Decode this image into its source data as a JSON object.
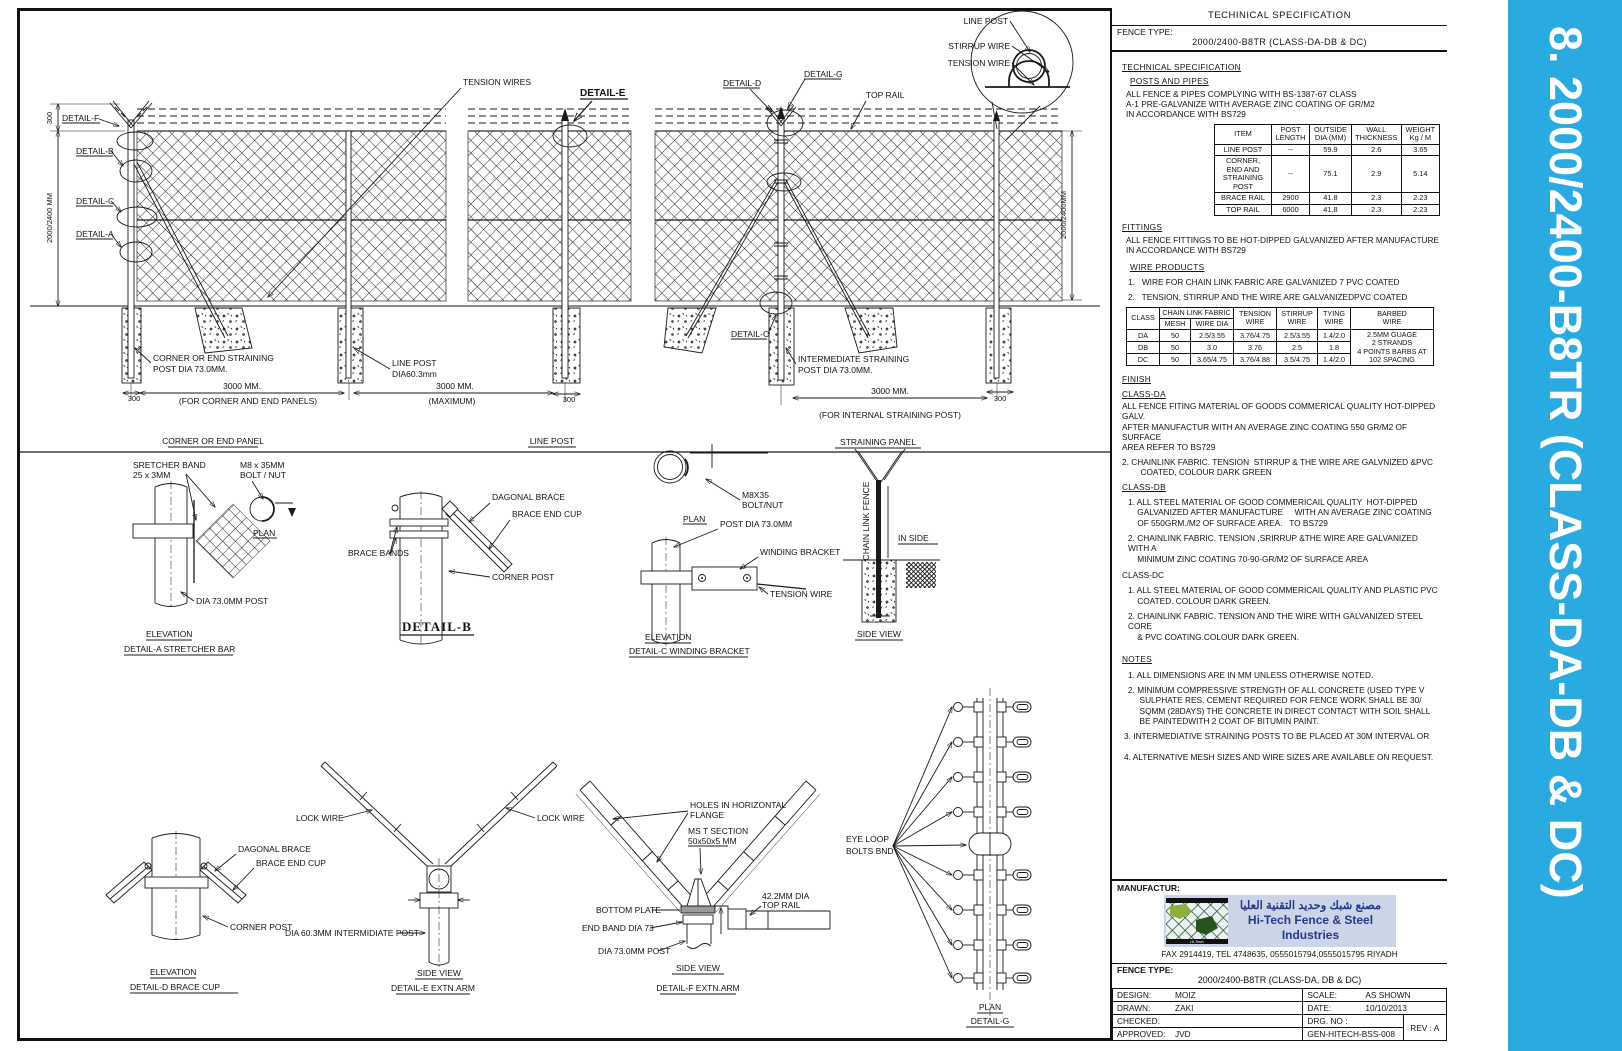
{
  "colors": {
    "accent_blue": "#29ABE2",
    "logo_blue": "#28368e",
    "logo_bg": "#ccd5e8",
    "logo_green": "#1e5b13"
  },
  "sidebar": {
    "title": "8. 2000/2400-B8TR (CLASS-DA-DB & DC)"
  },
  "panel": {
    "header": "TECHINICAL SPECIFICATION",
    "fence_type_label": "FENCE TYPE:",
    "fence_type_value": "2000/2400-B8TR (CLASS-DA-DB & DC)",
    "sec_heading": "TECHNICAL SPECIFICATION",
    "posts_heading": "POSTS AND PIPES",
    "posts_text": "ALL FENCE & PIPES COMPLYING WITH BS-1387-67 CLASS\nA-1 PRE-GALVANIZE WITH AVERAGE ZINC COATING OF GR/M2\nIN ACCORDANCE WITH BS729",
    "posts_table": {
      "headers": [
        "ITEM",
        "POST\nLENGTH",
        "OUTSIDE\nDIA (MM)",
        "WALL\nTHICKNESS",
        "WEIGHT\nKg / M"
      ],
      "rows": [
        [
          "LINE POST",
          "--",
          "59.9",
          "2.6",
          "3.65"
        ],
        [
          "CORNER, END AND\nSTRAINING POST",
          "--",
          "75.1",
          "2.9",
          "5.14"
        ],
        [
          "BRACE RAIL",
          "2900",
          "41.8",
          "2.3",
          "2.23"
        ],
        [
          "TOP RAIL",
          "6000",
          "41.8",
          "2.3",
          "2.23"
        ]
      ]
    },
    "fittings_heading": "FITTINGS",
    "fittings_text": "ALL FENCE FITTINGS TO BE HOT-DIPPED GALVANIZED AFTER MANUFACTURE\nIN ACCORDANCE WITH BS729",
    "wire_products_heading": "WIRE PRODUCTS",
    "wire_item1": "1.   WIRE FOR CHAIN LINK FABRIC ARE GALVANIZED 7 PVC COATED",
    "wire_item2": "2.   TENSION, STIRRUP AND THE WIRE ARE GALVANIZEDPVC COATED",
    "wire_table": {
      "class_header": "CLASS",
      "chainlink_header": "CHAIN LINK FABRIC",
      "mesh_header": "MESH",
      "wiredia_header": "WIRE DIA",
      "tension_header": "TENSION\nWIRE",
      "stirrup_header": "STIRRUP\nWIRE",
      "tying_header": "TYING\nWIRE",
      "barbed_header": "BARBED\nWIRE",
      "rows": [
        [
          "DA",
          "50",
          "2.5/3.55",
          "3.76/4.75",
          "2.5/3.55",
          "1.4/2.0"
        ],
        [
          "DB",
          "50",
          "3.0",
          "3.76",
          "2.5",
          "1.8"
        ],
        [
          "DC",
          "50",
          "3.65/4.75",
          "3.76/4.88",
          "3.5/4.75",
          "1.4/2.0"
        ]
      ],
      "barbed_text": "2.5MM  GUAGE\n2 STRANDS\n4 POINTS BARBS AT\n102 SPACING"
    },
    "finish_heading": "FINISH",
    "class_da": "CLASS-DA",
    "da_text": "ALL FENCE FITING MATERIAL OF GOODS COMMERICAL QUALITY HOT-DIPPED GALV.\nAFTER MANUFACTUR WITH AN AVERAGE ZINC COATING 550 GR/M2 OF SURFACE\nAREA REFER TO BS729",
    "da_item2": "2. CHAINLINK FABRIC. TENSION  STIRRUP & THE WIRE ARE GALVNIZED &PVC\n        COATED, COLOUR DARK GREEN",
    "class_db": "CLASS-DB",
    "db_item1": "1. ALL STEEL MATERIAL OF GOOD COMMERICAIL QUALITY  HOT-DIPPED\n    GALVANIZED AFTER MANUFACTURE     WITH AN AVERAGE ZINC COATING\n    OF 550GRM./M2 OF SURFACE AREA.   TO BS729",
    "db_item2": "2. CHAINLINK FABRIC. TENSION ,SRIRRUP &THE WIRE ARE GALVANIZED WITH A\n    MINIMUM ZINC COATING 70-90-GR/M2 OF SURFACE AREA",
    "class_dc": "CLASS-DC",
    "dc_item1": "1. ALL STEEL MATERIAL OF GOOD COMMERICAIL QUALITY AND PLASTIC PVC\n    COATED. COLOUR DARK GREEN.",
    "dc_item2": "2. CHAINLINK FABRIC. TENSION AND THE WIRE WITH GALVANIZED STEEL CORE\n    & PVC COATING.COLOUR DARK GREEN.",
    "notes_heading": "NOTES",
    "notes": [
      "1. ALL DIMENSIONS ARE IN MM UNLESS OTHERWISE NOTED.",
      "2. MINIMUM COMPRESSIVE STRENGTH OF ALL CONCRETE (USED TYPE V\n     SULPHATE RES. CEMENT REQUIRED FOR FENCE WORK SHALL BE 30/\n     SQMM (28DAYS) THE CONCRETE IN DIRECT CONTACT WITH SOIL SHALL\n     BE PAINTEDWITH 2 COAT OF BITUMIN PAINT.",
      "3. INTERMEDIATIVE STRAINING POSTS TO BE PLACED AT 30M INTERVAL OR",
      "4. ALTERNATIVE MESH SIZES AND WIRE SIZES ARE AVAILABLE ON REQUEST."
    ]
  },
  "title_block": {
    "manufacturer_label": "MANUFACTUR:",
    "logo_arabic": "مصنع شبك وحديد التقنية العليا",
    "logo_english": "Hi-Tech Fence & Steel Industries",
    "logo_strip": "Hi-Tech",
    "contact": "FAX 2914419, TEL 4748635,   0555015794,0555015795 RIYADH",
    "fence_type_label": "FENCE TYPE:",
    "fence_type_value": "2000/2400-B8TR (CLASS-DA, DB & DC)",
    "design_label": "DESIGN:",
    "design_value": "MOIZ",
    "scale_label": "SCALE:",
    "scale_value": "AS SHOWN",
    "drawn_label": "DRAWN:",
    "drawn_value": "ZAKI",
    "date_label": "DATE:",
    "date_value": "10/10/2013",
    "checked_label": "CHECKED:",
    "checked_value": "",
    "drg_label": "DRG. NO :",
    "drg_value": "GEN-HITECH-BSS-008",
    "approved_label": "APPROVED:",
    "approved_value": "JVD",
    "rev": "REV : A"
  },
  "labels": {
    "line_post": "LINE POST",
    "stirrup_wire": "STIRRUP WIRE",
    "tension_wire": "TENSION WIRE",
    "tension_wires": "TENSION WIRES",
    "top_rail": "TOP RAIL",
    "detail_a": "DETAIL-A",
    "detail_b": "DETAIL-B",
    "detail_c": "DETAIL-C",
    "detail_d": "DETAIL-D",
    "detail_e": "DETAIL-E",
    "detail_f": "DETAIL-F",
    "detail_g": "DETAIL-G",
    "dim_300": "300",
    "dim_height": "2000/2400 MM",
    "dim_height_right": "2000/2400MM",
    "dim_3000": "3000 MM.",
    "cap_corner": "(FOR CORNER AND END PANELS)",
    "cap_max": "(MAXIMUM)",
    "cap_internal": "(FOR INTERNAL STRAINING POST)",
    "corner_straining_1": "CORNER OR END STRAINING",
    "corner_straining_2": "POST DIA 73.0MM.",
    "line_post_dia": "DIA60.3mm",
    "intermediate_1": "INTERMEDIATE STRAINING",
    "title_corner": "CORNER OR END PANEL",
    "title_straining": "STRAINING PANEL",
    "stretcher_1": "SRETCHER BAND",
    "stretcher_2": "25 x 3MM",
    "m8_1": "M8 x 35MM",
    "m8_2": "BOLT / NUT",
    "plan": "PLAN",
    "dia73_post": "DIA 73.0MM POST",
    "elevation": "ELEVATION",
    "detail_a_title": "DETAIL-A STRETCHER BAR",
    "brace_bands": "BRACE BANDS",
    "dagonal_brace": "DAGONAL BRACE",
    "brace_end_cup": "BRACE END CUP",
    "corner_post": "CORNER POST",
    "m8x35": "M8X35",
    "bolt_nut": "BOLT/NUT",
    "post_dia73": "POST DIA 73.0MM",
    "winding_bracket": "WINDING BRACKET",
    "detail_c_title": "DETAIL-C WINDING BRACKET",
    "chain_link_fence": "CHAIN LINK FENCE",
    "in_side": "IN SIDE",
    "side_view": "SIDE VIEW",
    "lock_wire": "LOCK WIRE",
    "detail_d_title": "DETAIL-D BRACE CUP",
    "dia603": "DIA 60.3MM INTERMIDIATE POST",
    "detail_e_title": "DETAIL-E EXTN.ARM",
    "holes_1": "HOLES IN HORIZONTAL",
    "holes_2": "FLANGE",
    "ms_t_1": "MS T SECTION",
    "ms_t_2": "50x50x5 MM",
    "bottom_plate": "BOTTOM PLATE",
    "end_band": "END BAND DIA 73",
    "dia_422": "42.2MM DIA",
    "detail_f_title": "DETAIL-F EXTN.ARM",
    "eye_loop_1": "EYE LOOP",
    "eye_loop_2": "BOLTS BND"
  }
}
